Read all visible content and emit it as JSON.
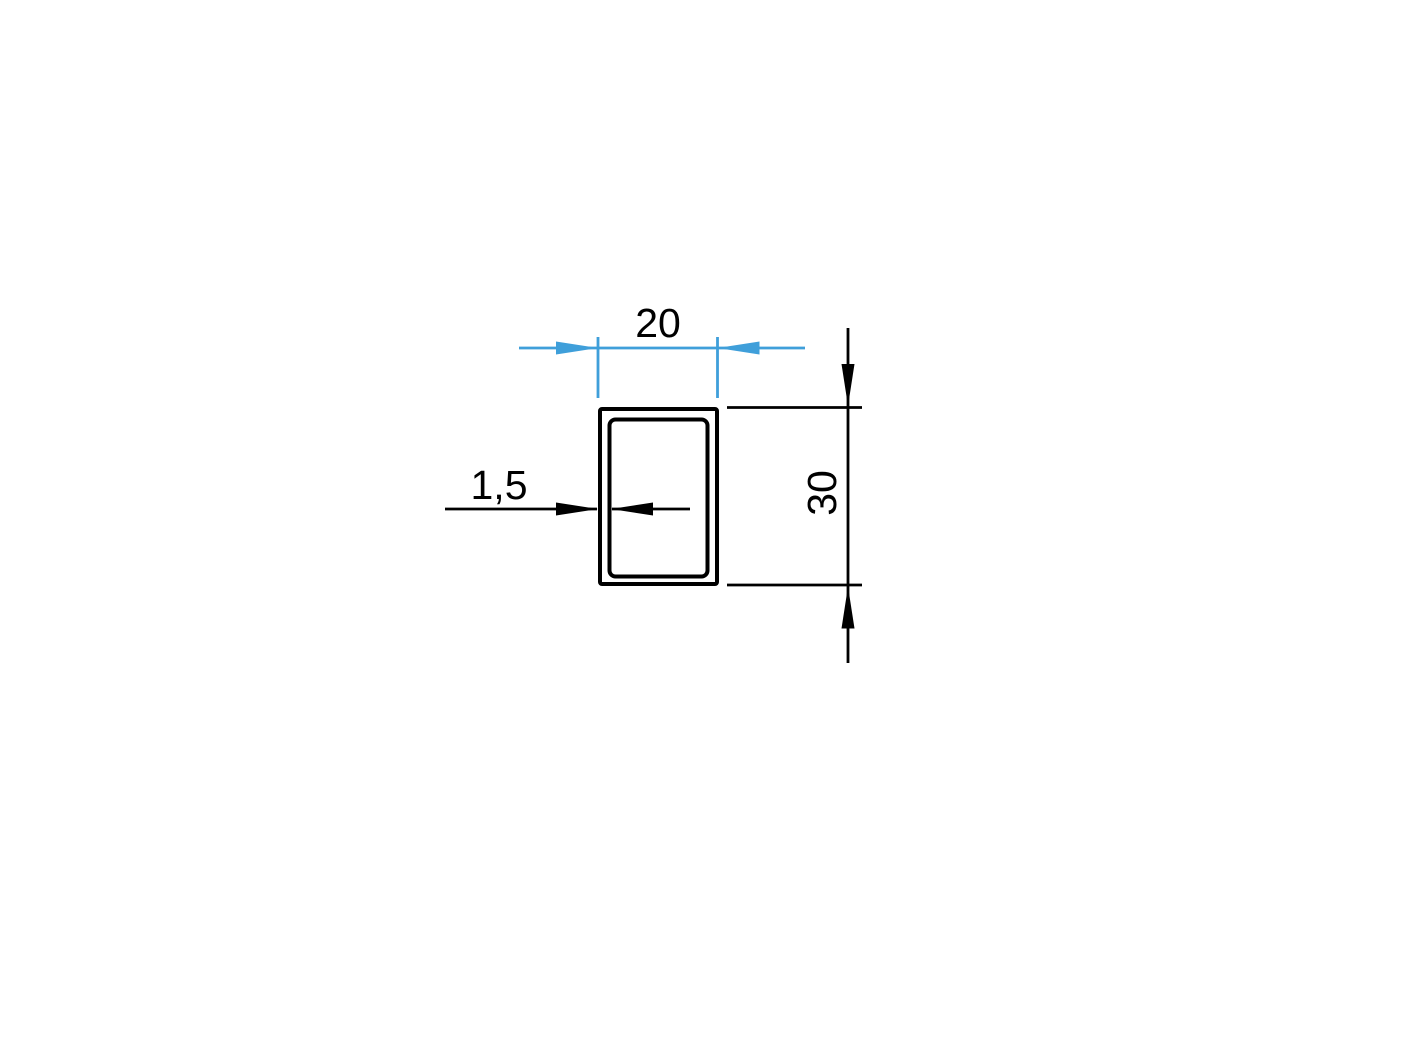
{
  "drawing": {
    "labels": {
      "width": "20",
      "height": "30",
      "wall_thickness": "1,5"
    },
    "colors": {
      "width_dimension": "#3F9FDA",
      "height_dimension": "#000000",
      "wall_thickness_dimension": "#000000",
      "profile_outline": "#000000",
      "background": "#FFFFFF"
    }
  }
}
